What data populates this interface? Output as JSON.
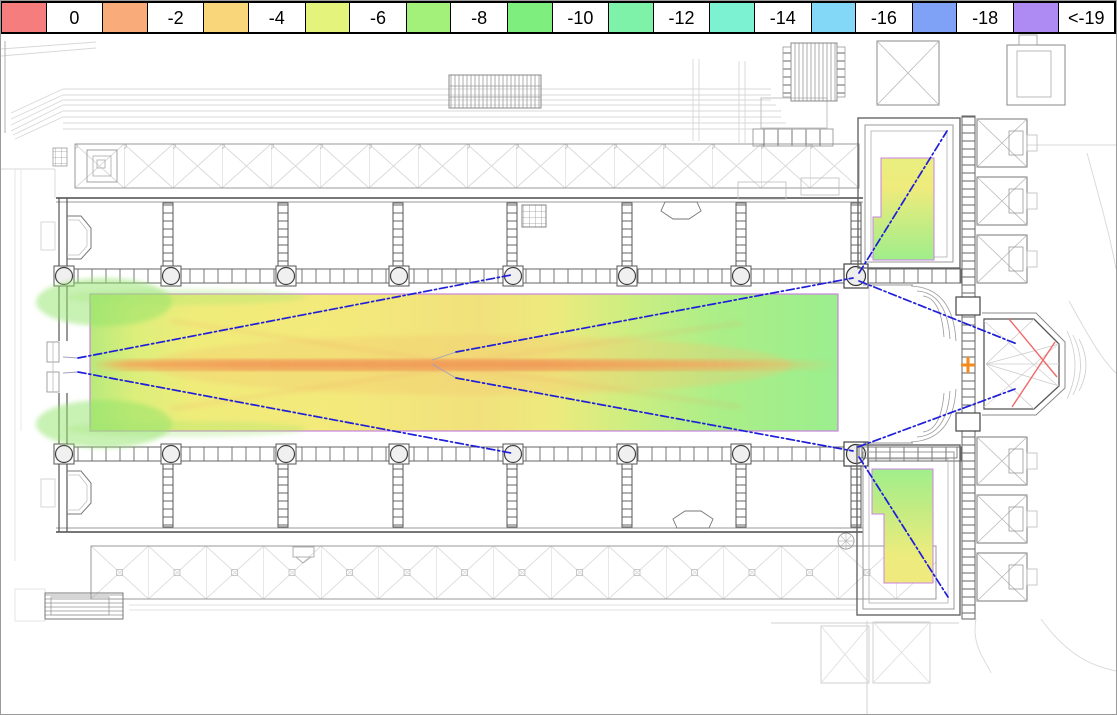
{
  "legend": {
    "items": [
      {
        "label": "0",
        "color": "#f57d7d"
      },
      {
        "label": "-2",
        "color": "#faab7a"
      },
      {
        "label": "-4",
        "color": "#f8d679"
      },
      {
        "label": "-6",
        "color": "#e3f37b"
      },
      {
        "label": "-8",
        "color": "#a3f07b"
      },
      {
        "label": "-10",
        "color": "#7eee7e"
      },
      {
        "label": "-12",
        "color": "#7df2a8"
      },
      {
        "label": "-14",
        "color": "#7df2d2"
      },
      {
        "label": "-16",
        "color": "#84d8f7"
      },
      {
        "label": "-18",
        "color": "#7fa2f6"
      },
      {
        "label": "<-19",
        "color": "#ad8bf3"
      }
    ]
  },
  "chart_data": {
    "type": "heatmap",
    "title": "",
    "legend_bins": [
      {
        "label": "0",
        "color": "#f57d7d"
      },
      {
        "label": "-2",
        "color": "#faab7a"
      },
      {
        "label": "-4",
        "color": "#f8d679"
      },
      {
        "label": "-6",
        "color": "#e3f37b"
      },
      {
        "label": "-8",
        "color": "#a3f07b"
      },
      {
        "label": "-10",
        "color": "#7eee7e"
      },
      {
        "label": "-12",
        "color": "#7df2a8"
      },
      {
        "label": "-14",
        "color": "#7df2d2"
      },
      {
        "label": "-16",
        "color": "#84d8f7"
      },
      {
        "label": "-18",
        "color": "#7fa2f6"
      },
      {
        "label": "<-19",
        "color": "#ad8bf3"
      }
    ],
    "regions": [
      {
        "name": "nave-central-axis-stripe",
        "approx_level": "-2 to -3"
      },
      {
        "name": "nave-main-floor",
        "approx_level": "-4 to -6"
      },
      {
        "name": "nave-west-and-edge-zones",
        "approx_level": "-8 to -10"
      },
      {
        "name": "northeast-side-room",
        "approx_level": "-6 to -10"
      },
      {
        "name": "southeast-side-room",
        "approx_level": "-6 to -10"
      }
    ],
    "annotations": [
      {
        "name": "source-cross-marker",
        "symbol": "+",
        "color": "#f28a1c"
      },
      {
        "name": "aiming-lines",
        "style": "dash-dot",
        "color": "#1f1fd9"
      },
      {
        "name": "apse-crossed-lines",
        "color": "#ef6a6a"
      },
      {
        "name": "coverage-area-outline",
        "color": "#c883e0"
      }
    ]
  }
}
